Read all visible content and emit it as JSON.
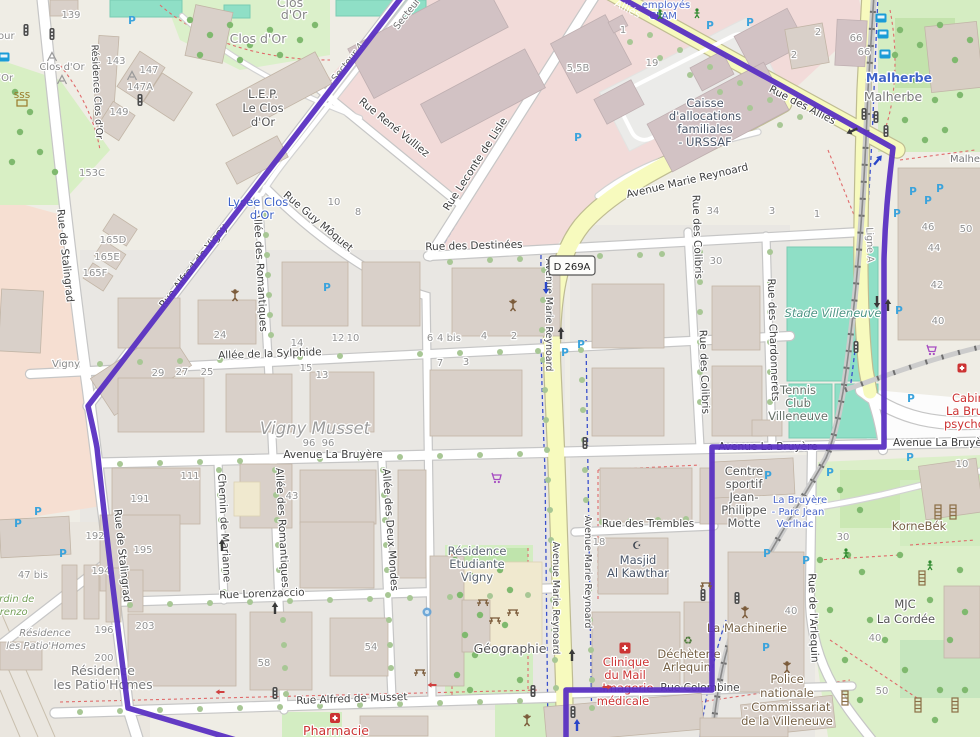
{
  "route": {
    "color": "#5A30C2"
  },
  "shield": {
    "ref": "D 269A"
  },
  "icons": {
    "parking_letter": "P",
    "recycle_glyph": "♻",
    "mosque_glyph": "☪"
  },
  "streets": {
    "stalingrad": "Rue de Stalingrad",
    "vigny": "Rue Alfred de Vigny",
    "secteur4": "Secteur 4",
    "vulliez": "Rue René Vulliez",
    "leconte": "Rue Leconte de Lisle",
    "moquet": "Rue Guy Môquet",
    "destinees": "Rue des Destinées",
    "sylphide": "Allée de la Sylphide",
    "labruyere": "Avenue La Bruyère",
    "lorenzaccio": "Rue Lorenzaccio",
    "musset": "Rue Alfred de Musset",
    "romantiques": "Allée des Romantiques",
    "marianne": "Chemin de Marianne",
    "deuxmondes": "Allée des Deux Mondes",
    "colibris": "Rue des Colibris",
    "chardonnerets": "Rue des Chardonnerets",
    "trembles": "Rue des Trembles",
    "colombine": "Rue Colombine",
    "arlequin": "Rue de l'Arlequin",
    "allies": "Rue des Alliés",
    "allies_short": "Alliés",
    "reynoard": "Avenue Marie Reynoard",
    "lignea": "Ligne A",
    "residence_rd": "Résidence Clos d'Or"
  },
  "places": {
    "closdor": "Clos d'Or",
    "clos": "Clos",
    "dor": "d'Or",
    "our": "our",
    "lep1": "L.E.P.",
    "lep2": "Le Clos",
    "lep3": "d'Or",
    "lycee1": "Lycée Clos",
    "lycee2": "d'Or",
    "vigny": "Vigny",
    "vignymusset": "Vigny Musset",
    "caf1": "Caisse",
    "caf2": "d'allocations",
    "caf3": "familiales",
    "caf4": "- URSSAF",
    "malherbe": "Malherbe",
    "stade": "Stade Villeneuve",
    "tennis1": "Tennis",
    "tennis2": "Club",
    "tennis3": "Villeneuve",
    "cs1": "Centre",
    "cs2": "sportif",
    "cs3": "Jean-",
    "cs4": "Philippe",
    "cs5": "Motte",
    "parc1": "La Bruyère",
    "parc2": "- Parc Jean",
    "parc3": "Verlhac",
    "re1": "Résidence",
    "re2": "Etudiante",
    "re3": "Vigny",
    "geographie": "Géographie",
    "masjid1": "Masjid",
    "masjid2": "Al Kawthar",
    "cl1": "Clinique",
    "cl2": "du Mail",
    "cl3": "- Imagerie",
    "cl4": "médicale",
    "dech1": "Déchèterie",
    "dech2": "Arlequin",
    "machinerie": "La Machinerie",
    "pol1": "Police",
    "pol2": "nationale",
    "pol3": "- Commissariat",
    "pol4": "de la Villeneuve",
    "mjc1": "MJC",
    "mjc2": "La Cordée",
    "kornebek": "KorneBék",
    "ph1": "Résidence",
    "ph2": "les Patio'Homes",
    "jardin1": "Jardin de",
    "jardin2": "Lorenzo",
    "cab1": "Cabinet",
    "cab2": "La Bruyère",
    "cab3": "psychologue",
    "emp1": "employés",
    "emp2": "CPAM",
    "pharmacie": "Pharmacie"
  },
  "housenumbers": {
    "n139": "139",
    "n143": "143",
    "n147": "147",
    "n147a": "147A",
    "n149": "149",
    "n153c": "153C",
    "n165d": "165D",
    "n165e": "165E",
    "n165f": "165F",
    "n24": "24",
    "n29": "29",
    "n27": "27",
    "n25": "25",
    "n14": "14",
    "n12": "12",
    "n10": "10",
    "n15": "15",
    "n13": "13",
    "n8": "8",
    "n6": "6",
    "n4bis": "4 bis",
    "n4": "4",
    "n2": "2",
    "n7": "7",
    "n3": "3",
    "n34": "34",
    "n1": "1",
    "n30": "30",
    "n111": "111",
    "n191": "191",
    "n195": "195",
    "n43": "43",
    "n96": "96",
    "n192": "192",
    "n194": "194",
    "n47bis": "47 bis",
    "n196": "196",
    "n200": "200",
    "n203": "203",
    "n58": "58",
    "n54": "54",
    "n18": "18",
    "n46": "46",
    "n50": "50",
    "n44": "44",
    "n42": "42",
    "n40": "40",
    "n66": "66",
    "n19": "19",
    "n55b": "5,5B"
  }
}
